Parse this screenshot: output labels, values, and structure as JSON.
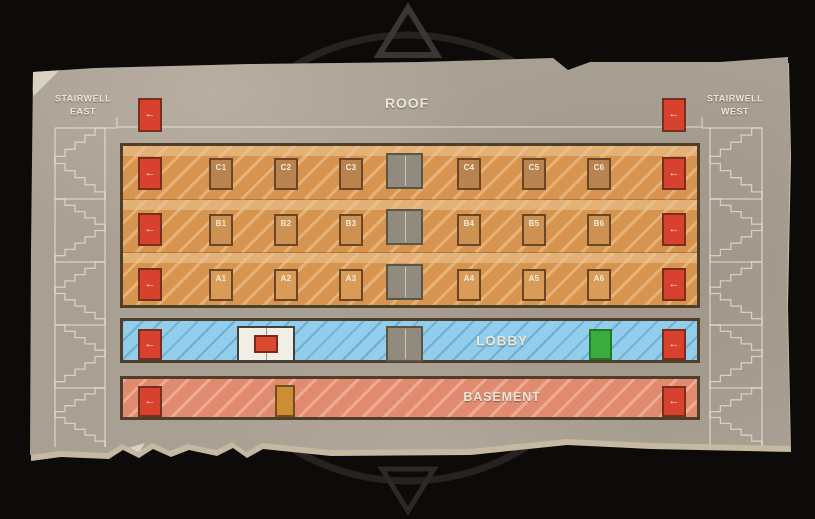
{
  "titles": {
    "roof": "ROOF",
    "lobby": "LOBBY",
    "basement": "BASEMENT"
  },
  "stairwells": {
    "east": {
      "line1": "STAIRWELL",
      "line2": "EAST"
    },
    "west": {
      "line1": "STAIRWELL",
      "line2": "WEST"
    }
  },
  "floors": [
    {
      "name": "Floor C",
      "rooms": [
        "C1",
        "C2",
        "C3",
        "C4",
        "C5",
        "C6"
      ]
    },
    {
      "name": "Floor B",
      "rooms": [
        "B1",
        "B2",
        "B3",
        "B4",
        "B5",
        "B6"
      ]
    },
    {
      "name": "Floor A",
      "rooms": [
        "A1",
        "A2",
        "A3",
        "A4",
        "A5",
        "A6"
      ]
    }
  ],
  "door_arrow_glyph": "←",
  "colors": {
    "paper": "#a9a094",
    "outline_brown": "#4f3e2a",
    "floor_orange": "#d7944f",
    "lobby_blue": "#92cdec",
    "basement_red": "#e08b70",
    "exit_door_red": "#d8412d",
    "green_door": "#3cab40",
    "basement_door_orange": "#cf8d33",
    "elevator_gray": "#908b7e",
    "room_door_c": "#b8834e",
    "room_door_b": "#cd9252",
    "room_door_a": "#d99c58",
    "entrance_marker_red": "#d84b30",
    "stair_line": "#ece5d5"
  }
}
